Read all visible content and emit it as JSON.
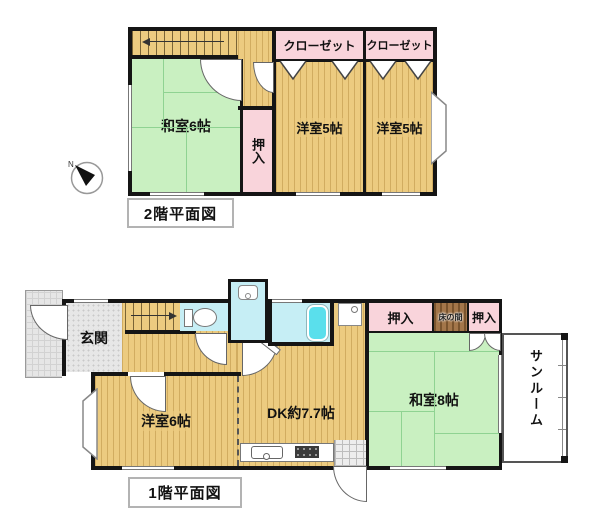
{
  "floor2": {
    "title": "2階平面図",
    "rooms": {
      "closet_left": "クローゼット",
      "closet_right": "クローゼット",
      "washitsu6": "和室6帖",
      "oshiire": "押入",
      "yoshitsu5_left": "洋室5帖",
      "yoshitsu5_right": "洋室5帖"
    }
  },
  "floor1": {
    "title": "1階平面図",
    "rooms": {
      "genkan": "玄関",
      "yoshitsu6": "洋室6帖",
      "dk": "DK約7.7帖",
      "oshiire_left": "押入",
      "tokonoma": "床の間",
      "oshiire_right": "押入",
      "washitsu8": "和室8帖",
      "sunroom": "サンルーム"
    }
  },
  "compass": {
    "direction": "N"
  },
  "colors": {
    "wall": "#151515",
    "wood_floor": "#ECCB80",
    "tatami_green": "#C9F0C1",
    "closet_pink": "#F9D4DB",
    "wet_room_cyan": "#C6EEF5",
    "bathtub_cyan": "#5ADFEC",
    "tokonoma_brown": "#A3764A",
    "porch_gray": "#E6E6E6"
  }
}
